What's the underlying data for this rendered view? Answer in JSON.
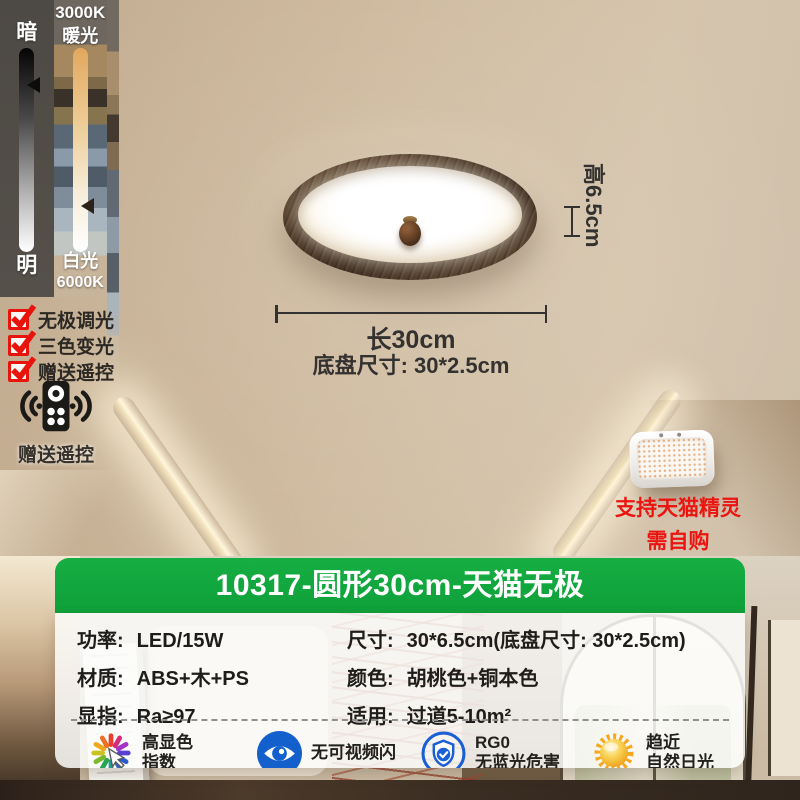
{
  "control_panel": {
    "brightness": {
      "top": "暗",
      "bottom": "明"
    },
    "color_temp": {
      "top_line1": "3000K",
      "top_line2": "暖光",
      "bottom_line1": "白光",
      "bottom_line2": "6000K"
    }
  },
  "features": [
    {
      "label": "无极调光"
    },
    {
      "label": "三色变光"
    },
    {
      "label": "赠送遥控"
    }
  ],
  "remote": {
    "caption": "赠送遥控",
    "icon": "remote-control-icon"
  },
  "dimensions": {
    "height": "高6.5cm",
    "length": "长30cm",
    "base": "底盘尺寸:  30*2.5cm"
  },
  "speaker": {
    "caption_line1": "支持天猫精灵",
    "caption_line2": "需自购"
  },
  "panel": {
    "title": "10317-圆形30cm-天猫无极",
    "specs": [
      {
        "label": "功率:",
        "value": "LED/15W"
      },
      {
        "label": "尺寸:",
        "value": "30*6.5cm(底盘尺寸: 30*2.5cm)"
      },
      {
        "label": "材质:",
        "value": "ABS+木+PS"
      },
      {
        "label": "颜色:",
        "value": "胡桃色+铜本色"
      },
      {
        "label": "显指:",
        "value": "Ra≥97"
      },
      {
        "label": "适用:",
        "value": "过道5-10m²"
      }
    ],
    "badges": [
      {
        "icon": "color-wheel-icon",
        "line1": "高显色",
        "line2": "指数"
      },
      {
        "icon": "eye-icon",
        "line1": "无可视频闪",
        "line2": ""
      },
      {
        "icon": "shield-check-icon",
        "line1": "RG0",
        "line2": "无蓝光危害"
      },
      {
        "icon": "sun-icon",
        "line1": "趋近",
        "line2": "自然日光"
      }
    ]
  },
  "colors": {
    "brand_green": "#12a53c",
    "accent_red": "#e8140c",
    "icon_blue": "#1a5fd6",
    "sun_orange": "#f5a81e"
  }
}
